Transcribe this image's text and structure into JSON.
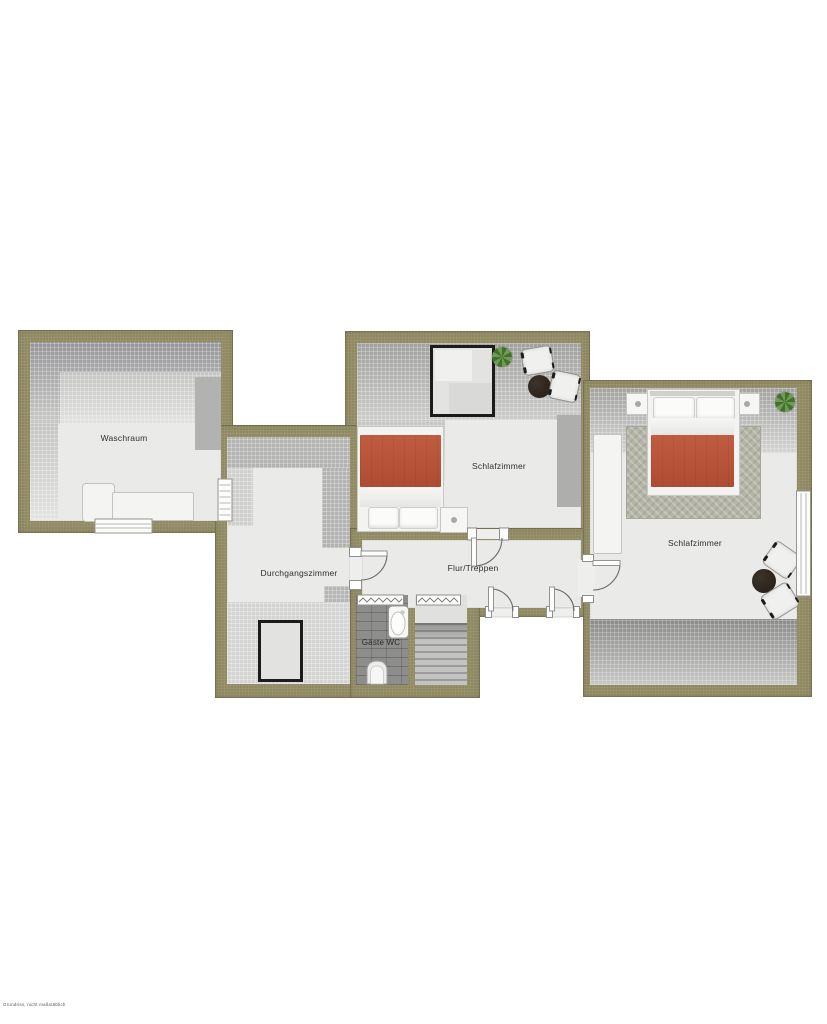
{
  "plan": {
    "type": "floorplan-upper-storey",
    "watermark": "Grundriss, nicht maßstäblich"
  },
  "rooms": {
    "waschraum": {
      "label": "Waschraum"
    },
    "schlafzimmer_mitte": {
      "label": "Schlafzimmer"
    },
    "schlafzimmer_rechts": {
      "label": "Schlafzimmer"
    },
    "durchgangszimmer": {
      "label": "Durchgangszimmer"
    },
    "flur": {
      "label": "Flur/Treppen"
    },
    "gaeste_wc": {
      "label": "Gäste WC"
    }
  },
  "furniture": {
    "waschraum": [
      "counter",
      "cabinet"
    ],
    "schlafzimmer_mitte": [
      "double-bed",
      "nightstand",
      "roof-window",
      "plant",
      "2-chairs",
      "round-table"
    ],
    "schlafzimmer_rechts": [
      "double-bed",
      "2-nightstands",
      "rug",
      "wardrobe",
      "plant",
      "2-chairs",
      "round-table"
    ],
    "durchgangszimmer": [
      "roof-window"
    ],
    "gaeste_wc": [
      "bathtub",
      "toilet",
      "radiator"
    ],
    "treppe": [
      "staircase",
      "radiator"
    ]
  },
  "colors": {
    "wall": "#8f8a62",
    "floor": "#eaeae8",
    "bed_red": "#ae4c33",
    "table_dark": "#241d15",
    "plant": "#44702f",
    "wc_tile": "#8d8d8b",
    "label": "#2f2f2f"
  }
}
